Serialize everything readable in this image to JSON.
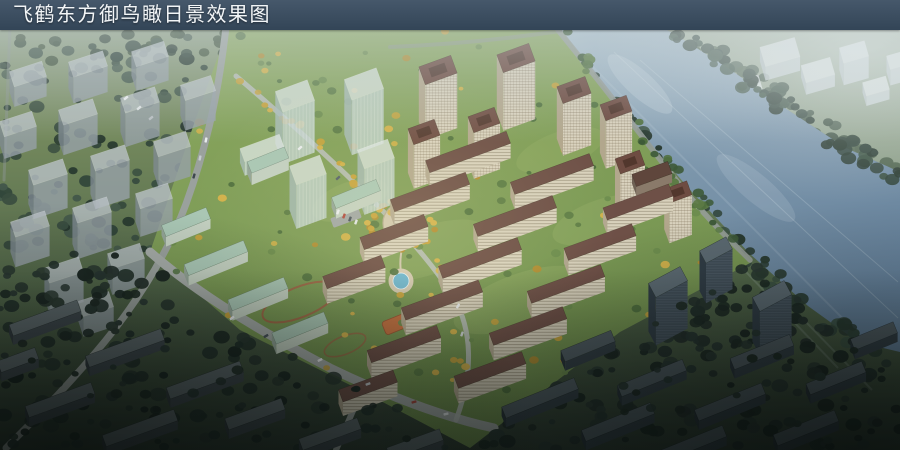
{
  "title_bar": {
    "title": "飞鹤东方御鸟瞰日景效果图"
  },
  "scene": {
    "palette": {
      "title_bar_bg": "#3a4c5e",
      "title_text": "#f2f5f7",
      "water_deep": "#64809a",
      "water_mid": "#7d97ac",
      "water_haze": "#aabfcc",
      "far_shore": "#97a791",
      "tree_dark": "#31443a",
      "tree_deep": "#202c26",
      "tree_mid": "#3a4e40",
      "tree_autumn": "#c6a33e",
      "core_ground": "#7d9a55",
      "lawn": "#93ad66",
      "road_light": "#b7bcb6",
      "road_mid": "#9aa19d",
      "facade_beige": "#d9d2be",
      "facade_shade": "#b2a78d",
      "roof_brown": "#6e4c42",
      "glass_massing": "#c4d4d2",
      "context_massing": "#97a1a8",
      "white_massing": "#e9eef1",
      "dark_slab": "#3f484d",
      "teal_roof": "#a9c6b4",
      "plaza_paving": "#cfc5ad",
      "pool_water": "#6fb7d0",
      "playground": "#c4703f"
    }
  }
}
